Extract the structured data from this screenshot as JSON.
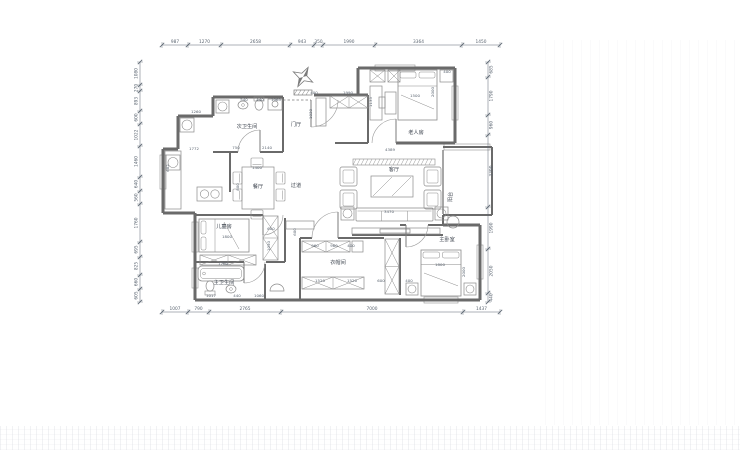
{
  "meta": {
    "description": "residential floor plan CAD drawing"
  },
  "colors": {
    "bg": "#ffffff",
    "wall": "#6a6a6a",
    "inner": "#7b7b7b",
    "furn": "#8a8a8a",
    "window": "#a2a2a2",
    "dim": "#5a6470",
    "text": "#3f4650",
    "door": "#9a9a9a"
  },
  "plan": {
    "rooms": [
      {
        "id": "room-label-second-bath",
        "t": "次卫生间",
        "x": 247,
        "y": 128
      },
      {
        "id": "room-label-foyer",
        "t": "门厅",
        "x": 296,
        "y": 126
      },
      {
        "id": "room-label-elderly-room",
        "t": "老人房",
        "x": 416,
        "y": 134
      },
      {
        "id": "room-label-dining",
        "t": "餐厅",
        "x": 258,
        "y": 188
      },
      {
        "id": "room-label-corridor",
        "t": "过道",
        "x": 296,
        "y": 187
      },
      {
        "id": "room-label-living",
        "t": "客厅",
        "x": 394,
        "y": 171
      },
      {
        "id": "room-label-children-room",
        "t": "儿童房",
        "x": 224,
        "y": 228
      },
      {
        "id": "room-label-master-bath",
        "t": "主卫生间",
        "x": 224,
        "y": 284
      },
      {
        "id": "room-label-cloakroom",
        "t": "衣帽间",
        "x": 338,
        "y": 264
      },
      {
        "id": "room-label-master-bedroom",
        "t": "主卧室",
        "x": 447,
        "y": 241
      },
      {
        "id": "room-label-balcony",
        "t": "阳台",
        "x": 452,
        "y": 197,
        "r": 1
      }
    ],
    "dims": {
      "top": {
        "y": 45,
        "ticks": [
          162,
          188,
          221,
          290,
          314,
          323,
          375,
          462,
          500
        ],
        "values": [
          "987",
          "1270",
          "2658",
          "943",
          "350",
          "1990",
          "3364",
          "1450"
        ]
      },
      "bottom": {
        "y": 312,
        "ticks": [
          162,
          188,
          209,
          281,
          463,
          500
        ],
        "values": [
          "1007",
          "790",
          "2765",
          "7000",
          "1437"
        ]
      },
      "left": {
        "x": 140,
        "ticks": [
          62,
          85,
          91,
          111,
          124,
          146,
          177,
          191,
          204,
          242,
          257,
          275,
          289,
          302
        ],
        "values": [
          "1080",
          "270",
          "893",
          "600",
          "1022",
          "1460",
          "640",
          "560",
          "1760",
          "695",
          "825",
          "660",
          "605"
        ]
      },
      "right": {
        "x": 488,
        "ticks": [
          62,
          77,
          115,
          135,
          207,
          249,
          293,
          302
        ],
        "values": [
          "685",
          "1790",
          "960",
          "3390",
          "1990",
          "2050",
          "440"
        ]
      }
    },
    "inner_dims": [
      {
        "t": "1260",
        "x": 196,
        "y": 113
      },
      {
        "t": "540",
        "x": 244,
        "y": 101
      },
      {
        "t": "440",
        "x": 260,
        "y": 101
      },
      {
        "t": "1065",
        "x": 276,
        "y": 101
      },
      {
        "t": "1772",
        "x": 194,
        "y": 150
      },
      {
        "t": "682",
        "x": 169,
        "y": 168,
        "r": 1
      },
      {
        "t": "750",
        "x": 236,
        "y": 149
      },
      {
        "t": "2140",
        "x": 267,
        "y": 149
      },
      {
        "t": "1400",
        "x": 257,
        "y": 169
      },
      {
        "t": "800",
        "x": 239,
        "y": 187,
        "r": 1
      },
      {
        "t": "400",
        "x": 314,
        "y": 94
      },
      {
        "t": "1990",
        "x": 348,
        "y": 94
      },
      {
        "t": "1030",
        "x": 312,
        "y": 114,
        "r": 1
      },
      {
        "t": "1135",
        "x": 372,
        "y": 102,
        "r": 1
      },
      {
        "t": "1500",
        "x": 415,
        "y": 97
      },
      {
        "t": "2000",
        "x": 434,
        "y": 92,
        "r": 1
      },
      {
        "t": "400",
        "x": 447,
        "y": 73
      },
      {
        "t": "4389",
        "x": 390,
        "y": 151
      },
      {
        "t": "3470",
        "x": 389,
        "y": 213
      },
      {
        "t": "1800",
        "x": 227,
        "y": 238
      },
      {
        "t": "600",
        "x": 271,
        "y": 230
      },
      {
        "t": "1050",
        "x": 270,
        "y": 246,
        "r": 1
      },
      {
        "t": "600",
        "x": 296,
        "y": 232,
        "r": 1
      },
      {
        "t": "1700",
        "x": 223,
        "y": 265
      },
      {
        "t": "1017",
        "x": 211,
        "y": 297
      },
      {
        "t": "440",
        "x": 237,
        "y": 297
      },
      {
        "t": "1060",
        "x": 259,
        "y": 297
      },
      {
        "t": "960",
        "x": 315,
        "y": 247
      },
      {
        "t": "960",
        "x": 334,
        "y": 247
      },
      {
        "t": "400",
        "x": 351,
        "y": 247
      },
      {
        "t": "1520",
        "x": 320,
        "y": 282
      },
      {
        "t": "1520",
        "x": 352,
        "y": 282
      },
      {
        "t": "600",
        "x": 381,
        "y": 282
      },
      {
        "t": "400",
        "x": 409,
        "y": 282
      },
      {
        "t": "1800",
        "x": 440,
        "y": 266
      },
      {
        "t": "2000",
        "x": 465,
        "y": 272,
        "r": 1
      }
    ],
    "walls": [
      [
        213,
        97,
        283,
        97,
        3
      ],
      [
        213,
        97,
        213,
        116,
        3
      ],
      [
        178,
        116,
        213,
        116,
        3
      ],
      [
        178,
        116,
        178,
        149,
        3
      ],
      [
        163,
        149,
        178,
        149,
        3
      ],
      [
        163,
        149,
        163,
        213,
        3
      ],
      [
        163,
        213,
        195,
        213,
        3
      ],
      [
        195,
        213,
        195,
        300,
        3
      ],
      [
        195,
        300,
        480,
        300,
        3
      ],
      [
        480,
        225,
        480,
        300,
        3
      ],
      [
        443,
        225,
        480,
        225,
        3
      ],
      [
        455,
        68,
        455,
        143,
        3
      ],
      [
        358,
        68,
        455,
        68,
        3
      ],
      [
        358,
        68,
        358,
        96,
        3
      ],
      [
        314,
        95,
        368,
        95,
        3
      ],
      [
        396,
        143,
        455,
        143,
        3
      ],
      [
        368,
        95,
        368,
        143,
        2
      ],
      [
        335,
        143,
        368,
        143,
        2
      ],
      [
        443,
        147,
        492,
        147,
        2
      ],
      [
        492,
        147,
        492,
        215,
        2
      ],
      [
        443,
        215,
        492,
        215,
        2
      ],
      [
        443,
        150,
        443,
        214,
        1.2
      ],
      [
        283,
        97,
        283,
        152,
        2
      ],
      [
        213,
        152,
        238,
        152,
        2
      ],
      [
        260,
        152,
        283,
        152,
        2
      ],
      [
        230,
        152,
        230,
        192,
        2
      ],
      [
        195,
        215,
        263,
        215,
        2
      ],
      [
        285,
        218,
        285,
        262,
        2
      ],
      [
        195,
        262,
        244,
        262,
        2
      ],
      [
        266,
        262,
        285,
        262,
        2
      ],
      [
        265,
        264,
        265,
        300,
        2
      ],
      [
        300,
        238,
        300,
        300,
        2
      ],
      [
        300,
        238,
        312,
        238,
        2
      ],
      [
        338,
        238,
        384,
        238,
        2
      ],
      [
        400,
        238,
        400,
        295,
        2
      ],
      [
        400,
        225,
        406,
        225,
        2
      ],
      [
        428,
        225,
        443,
        225,
        2
      ],
      [
        352,
        235,
        443,
        235,
        2
      ],
      [
        443,
        215,
        443,
        225,
        2
      ]
    ],
    "dashed": [
      [
        283,
        100,
        311,
        100
      ]
    ],
    "windows": [
      [
        160,
        155,
        6,
        34
      ],
      [
        192,
        222,
        6,
        30
      ],
      [
        192,
        268,
        6,
        20
      ],
      [
        375,
        65,
        40,
        6
      ],
      [
        452,
        86,
        6,
        34
      ],
      [
        444,
        144,
        46,
        6
      ],
      [
        477,
        245,
        6,
        34
      ],
      [
        424,
        297,
        34,
        6
      ]
    ],
    "doors": [
      {
        "hx": 311,
        "hy": 100,
        "r": 27,
        "a0": 0,
        "a1": 90
      },
      {
        "hx": 260,
        "hy": 152,
        "r": 22,
        "a0": 180,
        "a1": 270
      },
      {
        "hx": 396,
        "hy": 143,
        "r": 24,
        "a0": 180,
        "a1": 270
      },
      {
        "hx": 263,
        "hy": 215,
        "r": 20,
        "a0": 0,
        "a1": 90
      },
      {
        "hx": 244,
        "hy": 262,
        "r": 21,
        "a0": 0,
        "a1": 90
      },
      {
        "hx": 338,
        "hy": 238,
        "r": 26,
        "a0": 180,
        "a1": 270
      },
      {
        "hx": 406,
        "hy": 225,
        "r": 22,
        "a0": 0,
        "a1": 90
      }
    ],
    "furniture": [
      {
        "t": "box_circle",
        "x": 216,
        "y": 100,
        "w": 13,
        "h": 13,
        "n": "washing-machine"
      },
      {
        "t": "sink",
        "x": 243,
        "y": 105,
        "n": "sink"
      },
      {
        "t": "toilet",
        "x": 259,
        "y": 104,
        "d": "s",
        "n": "toilet"
      },
      {
        "t": "rect",
        "x": 268,
        "y": 99,
        "w": 14,
        "h": 11,
        "n": "vanity"
      },
      {
        "t": "circle",
        "x": 275,
        "y": 104,
        "r": 3,
        "n": "basin"
      },
      {
        "t": "box_circle",
        "x": 180,
        "y": 118,
        "w": 14,
        "h": 14,
        "n": "laundry-box"
      },
      {
        "t": "rect",
        "x": 165,
        "y": 151,
        "w": 16,
        "h": 58,
        "n": "kitchen-counter"
      },
      {
        "t": "box_circle",
        "x": 166,
        "y": 155,
        "w": 14,
        "h": 15,
        "n": "kitchen-sink"
      },
      {
        "t": "stove",
        "x": 197,
        "y": 187,
        "w": 25,
        "h": 14,
        "n": "stove"
      },
      {
        "t": "rect",
        "x": 242,
        "y": 167,
        "w": 32,
        "h": 42,
        "n": "dining-table"
      },
      {
        "t": "chair",
        "x": 233,
        "y": 172,
        "w": 9,
        "h": 12,
        "n": "chair"
      },
      {
        "t": "chair",
        "x": 233,
        "y": 189,
        "w": 9,
        "h": 12,
        "n": "chair"
      },
      {
        "t": "chair",
        "x": 276,
        "y": 172,
        "w": 9,
        "h": 12,
        "n": "chair"
      },
      {
        "t": "chair",
        "x": 276,
        "y": 189,
        "w": 9,
        "h": 12,
        "n": "chair"
      },
      {
        "t": "chair",
        "x": 251,
        "y": 158,
        "w": 12,
        "h": 9,
        "n": "chair"
      },
      {
        "t": "chair",
        "x": 251,
        "y": 210,
        "w": 12,
        "h": 9,
        "n": "chair"
      },
      {
        "t": "rect",
        "x": 316,
        "y": 98,
        "w": 10,
        "h": 28,
        "n": "shoe-cabinet"
      },
      {
        "t": "xbox",
        "x": 330,
        "y": 96,
        "w": 38,
        "h": 12,
        "c": 2,
        "n": "entry-closet"
      },
      {
        "t": "xbox",
        "x": 370,
        "y": 70,
        "w": 15,
        "h": 12,
        "c": 1,
        "n": "cabinet"
      },
      {
        "t": "xbox",
        "x": 388,
        "y": 70,
        "w": 12,
        "h": 12,
        "c": 1,
        "n": "cabinet"
      },
      {
        "t": "bed",
        "x": 398,
        "y": 70,
        "w": 39,
        "h": 50,
        "p": "top",
        "n": "elderly-bed"
      },
      {
        "t": "rect",
        "x": 440,
        "y": 70,
        "w": 13,
        "h": 12,
        "n": "nightstand"
      },
      {
        "t": "rect",
        "x": 370,
        "y": 86,
        "w": 12,
        "h": 34,
        "n": "wardrobe"
      },
      {
        "t": "rect",
        "x": 385,
        "y": 92,
        "w": 11,
        "h": 22,
        "n": "desk"
      },
      {
        "t": "rect",
        "x": 379,
        "y": 97,
        "w": 6,
        "h": 11,
        "n": "desk-chair"
      },
      {
        "t": "hatchband",
        "x": 353,
        "y": 159,
        "w": 82,
        "h": 6,
        "n": "feature-wall"
      },
      {
        "t": "chair2",
        "x": 340,
        "y": 167,
        "w": 17,
        "h": 19,
        "n": "armchair"
      },
      {
        "t": "chair2",
        "x": 340,
        "y": 190,
        "w": 17,
        "h": 19,
        "n": "armchair"
      },
      {
        "t": "chair2",
        "x": 424,
        "y": 167,
        "w": 17,
        "h": 19,
        "n": "armchair"
      },
      {
        "t": "chair2",
        "x": 424,
        "y": 190,
        "w": 17,
        "h": 19,
        "n": "armchair"
      },
      {
        "t": "hatchrect",
        "x": 371,
        "y": 176,
        "w": 42,
        "h": 21,
        "n": "coffee-table"
      },
      {
        "t": "sofa",
        "x": 356,
        "y": 208,
        "w": 77,
        "h": 13,
        "n": "sofa"
      },
      {
        "t": "box_circle",
        "x": 341,
        "y": 207,
        "w": 13,
        "h": 13,
        "n": "side-table"
      },
      {
        "t": "box_circle",
        "x": 435,
        "y": 207,
        "w": 13,
        "h": 13,
        "n": "side-table"
      },
      {
        "t": "circle",
        "x": 453,
        "y": 222,
        "r": 6,
        "n": "round-table"
      },
      {
        "t": "rect",
        "x": 352,
        "y": 228,
        "w": 88,
        "h": 6,
        "n": "tv-cabinet"
      },
      {
        "t": "rect",
        "x": 380,
        "y": 229,
        "w": 30,
        "h": 4,
        "n": "tv"
      },
      {
        "t": "rect",
        "x": 286,
        "y": 221,
        "w": 28,
        "h": 8,
        "n": "hall-cabinet"
      },
      {
        "t": "bed",
        "x": 199,
        "y": 219,
        "w": 50,
        "h": 33,
        "p": "left",
        "n": "children-bed"
      },
      {
        "t": "xbox",
        "x": 200,
        "y": 255,
        "w": 56,
        "h": 10,
        "c": 2,
        "n": "low-cabinet"
      },
      {
        "t": "xbox",
        "x": 263,
        "y": 216,
        "w": 15,
        "h": 44,
        "c": 2,
        "v": true,
        "n": "wardrobe"
      },
      {
        "t": "tub",
        "x": 198,
        "y": 266,
        "w": 46,
        "h": 15,
        "n": "bathtub"
      },
      {
        "t": "toilet",
        "x": 210,
        "y": 287,
        "d": "n",
        "n": "toilet"
      },
      {
        "t": "sink",
        "x": 231,
        "y": 289,
        "n": "sink"
      },
      {
        "t": "halfcircle",
        "x": 277,
        "y": 291,
        "r": 7,
        "n": "basin"
      },
      {
        "t": "xbox",
        "x": 302,
        "y": 241,
        "w": 48,
        "h": 11,
        "c": 2,
        "n": "closet-shelf"
      },
      {
        "t": "rect",
        "x": 352,
        "y": 241,
        "w": 11,
        "h": 11,
        "n": "closet-box"
      },
      {
        "t": "xbox",
        "x": 302,
        "y": 277,
        "w": 62,
        "h": 12,
        "c": 2,
        "n": "closet-shelf"
      },
      {
        "t": "xbox",
        "x": 385,
        "y": 239,
        "w": 14,
        "h": 55,
        "c": 2,
        "v": true,
        "n": "tall-wardrobe"
      },
      {
        "t": "bed",
        "x": 421,
        "y": 250,
        "w": 40,
        "h": 46,
        "p": "top",
        "n": "master-bed"
      },
      {
        "t": "box_circle",
        "x": 406,
        "y": 283,
        "w": 12,
        "h": 12,
        "n": "nightstand"
      },
      {
        "t": "box_circle",
        "x": 464,
        "y": 283,
        "w": 12,
        "h": 12,
        "n": "nightstand"
      }
    ],
    "north": {
      "x": 303,
      "y": 77
    }
  }
}
